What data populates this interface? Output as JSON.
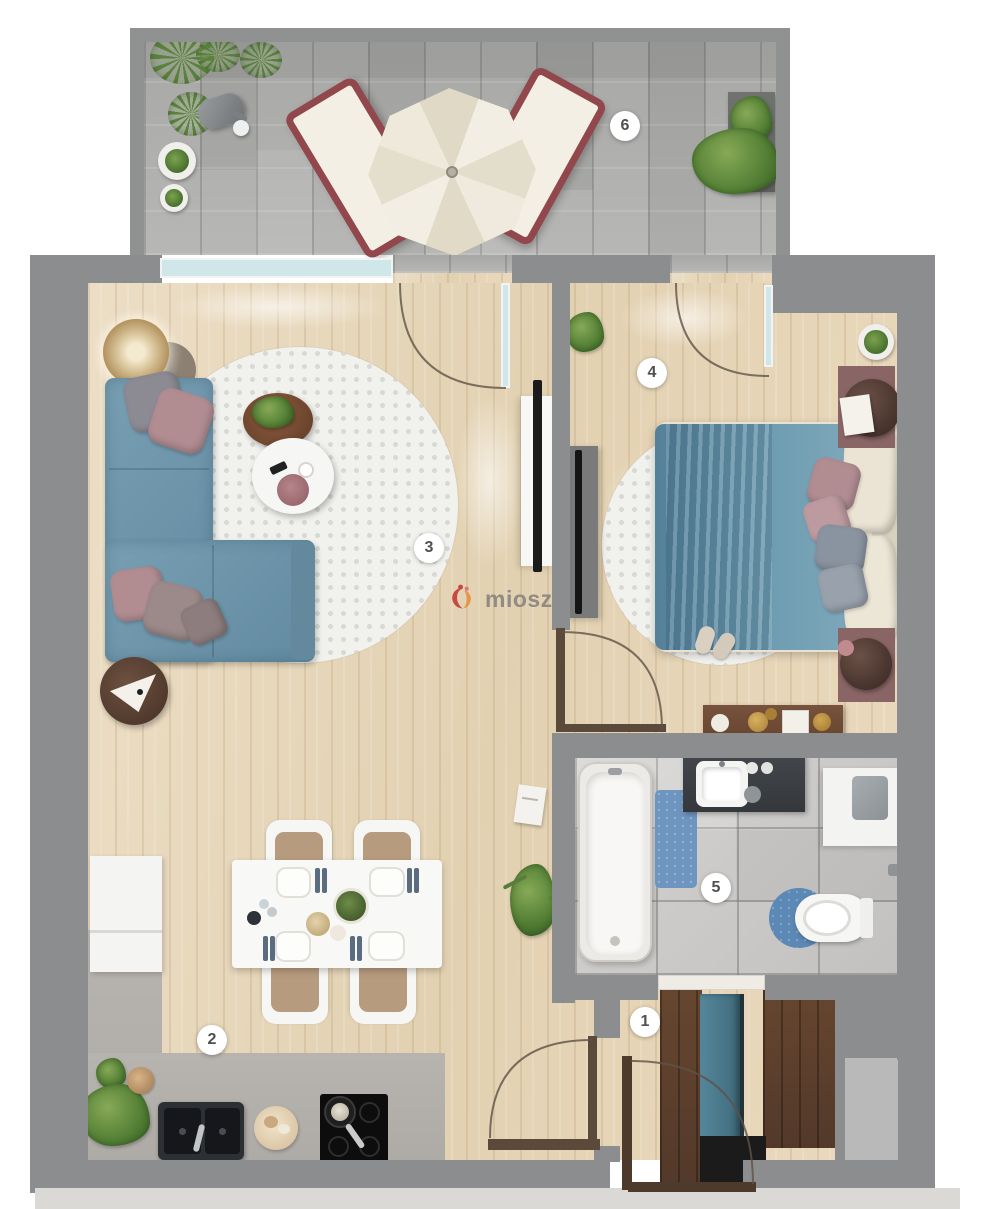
{
  "watermark": {
    "text": "miosz",
    "logo_colors": {
      "red": "#c2403a",
      "orange": "#e8923f",
      "pink": "#d8737f"
    }
  },
  "markers": [
    {
      "label": "1",
      "area": "hallway"
    },
    {
      "label": "2",
      "area": "kitchen-dining"
    },
    {
      "label": "3",
      "area": "living-room"
    },
    {
      "label": "4",
      "area": "bedroom"
    },
    {
      "label": "5",
      "area": "bathroom"
    },
    {
      "label": "6",
      "area": "terrace"
    }
  ],
  "palette": {
    "wall_gray": "#8b8d8e",
    "wood_floor": "#e7d9c0",
    "terrace_paving": "#b1b1b0",
    "bathroom_tile": "#cccbc9",
    "sofa_blue": "#6e94a8",
    "bed_blue": "#6c98ad",
    "pillow_mauve": "#b18d92",
    "lounger_maroon": "#91474c",
    "bath_mat_blue": "#5b88b4",
    "wardrobe_teal": "#4a7a8c",
    "glass_teal": "#cfe7e9",
    "marker_text": "#4f4f4f"
  }
}
